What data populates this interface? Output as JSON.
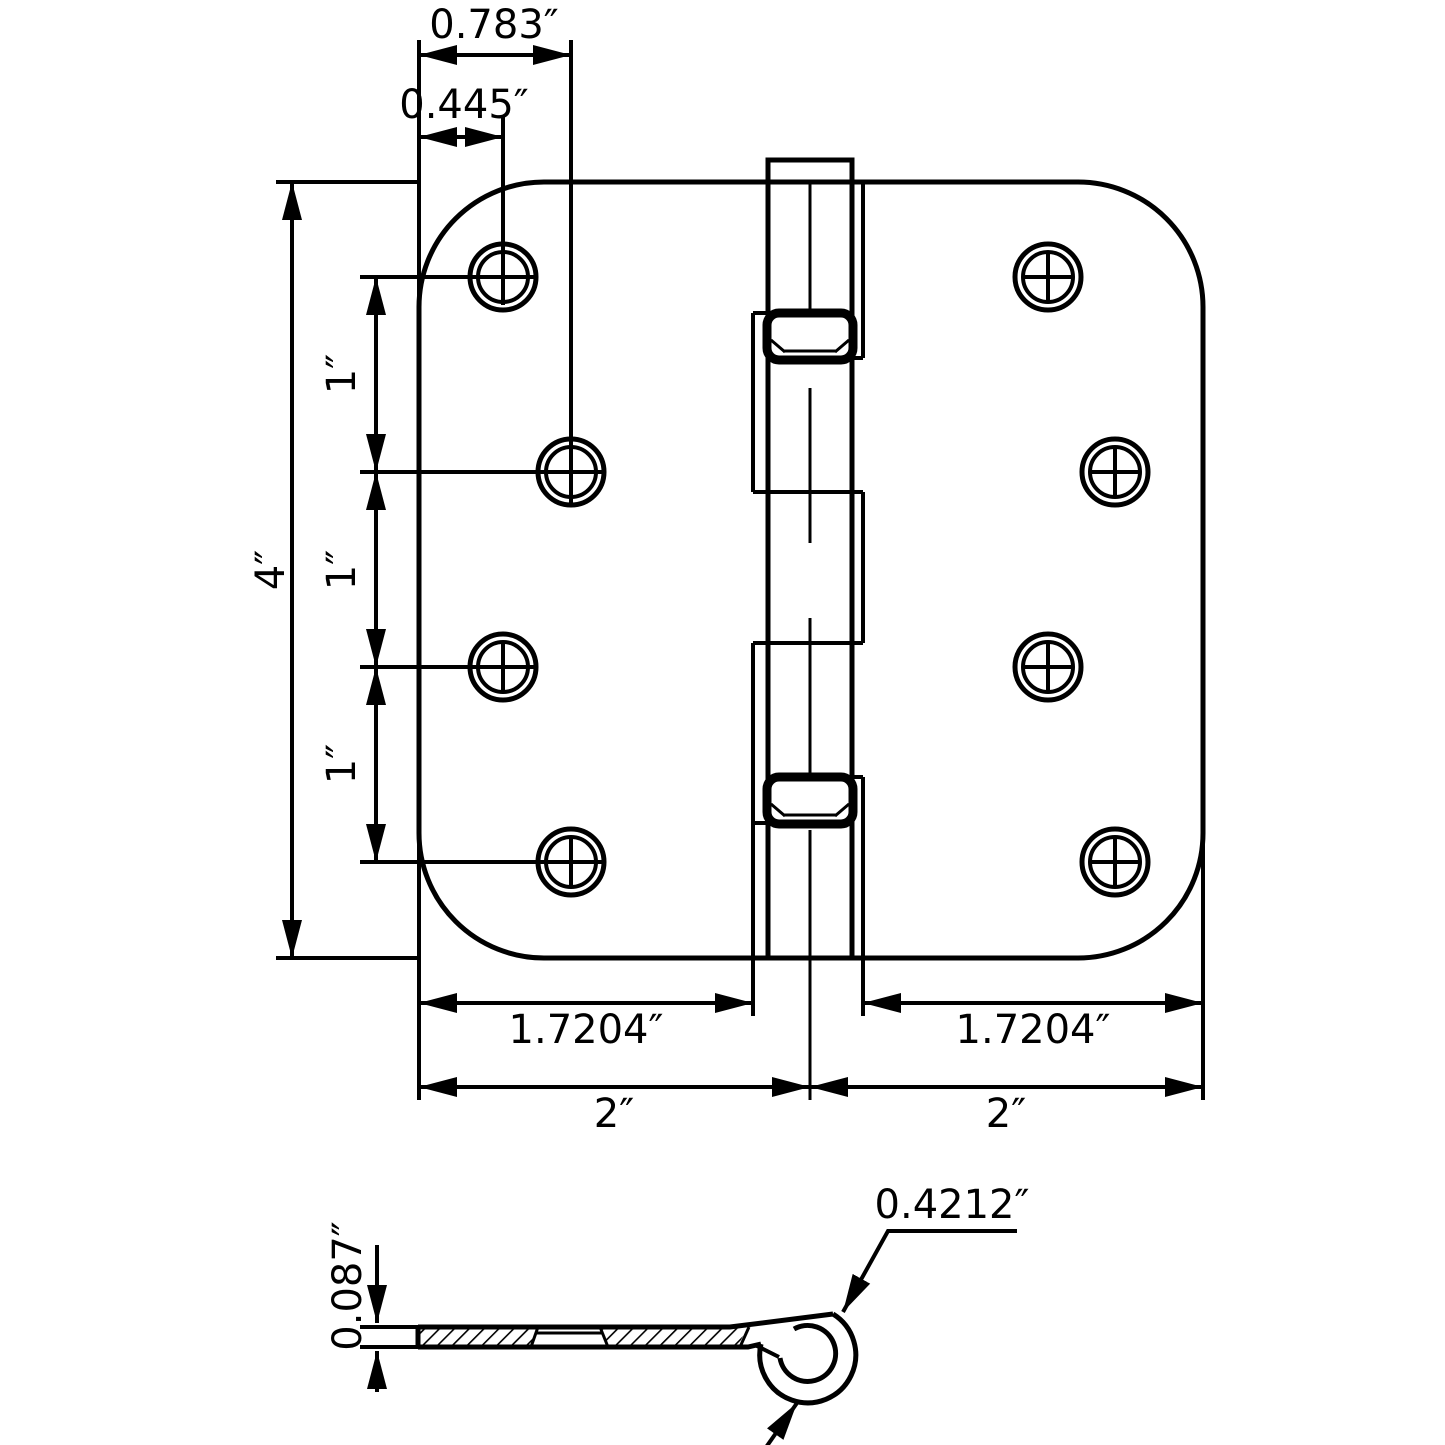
{
  "drawing": {
    "background": "#ffffff",
    "line_color": "#000000"
  },
  "top_view": {
    "dim_hole_col_outer": "0.783″",
    "dim_hole_col_inner": "0.445″",
    "dim_height": "4″",
    "dim_hole_spacing_a": "1″",
    "dim_hole_spacing_b": "1″",
    "dim_hole_spacing_c": "1″",
    "dim_leaf_left": "1.7204″",
    "dim_leaf_right": "1.7204″",
    "dim_half_left": "2″",
    "dim_half_right": "2″"
  },
  "side_view": {
    "dim_thickness": "0.087″",
    "dim_knuckle_diameter": "0.4212″"
  }
}
